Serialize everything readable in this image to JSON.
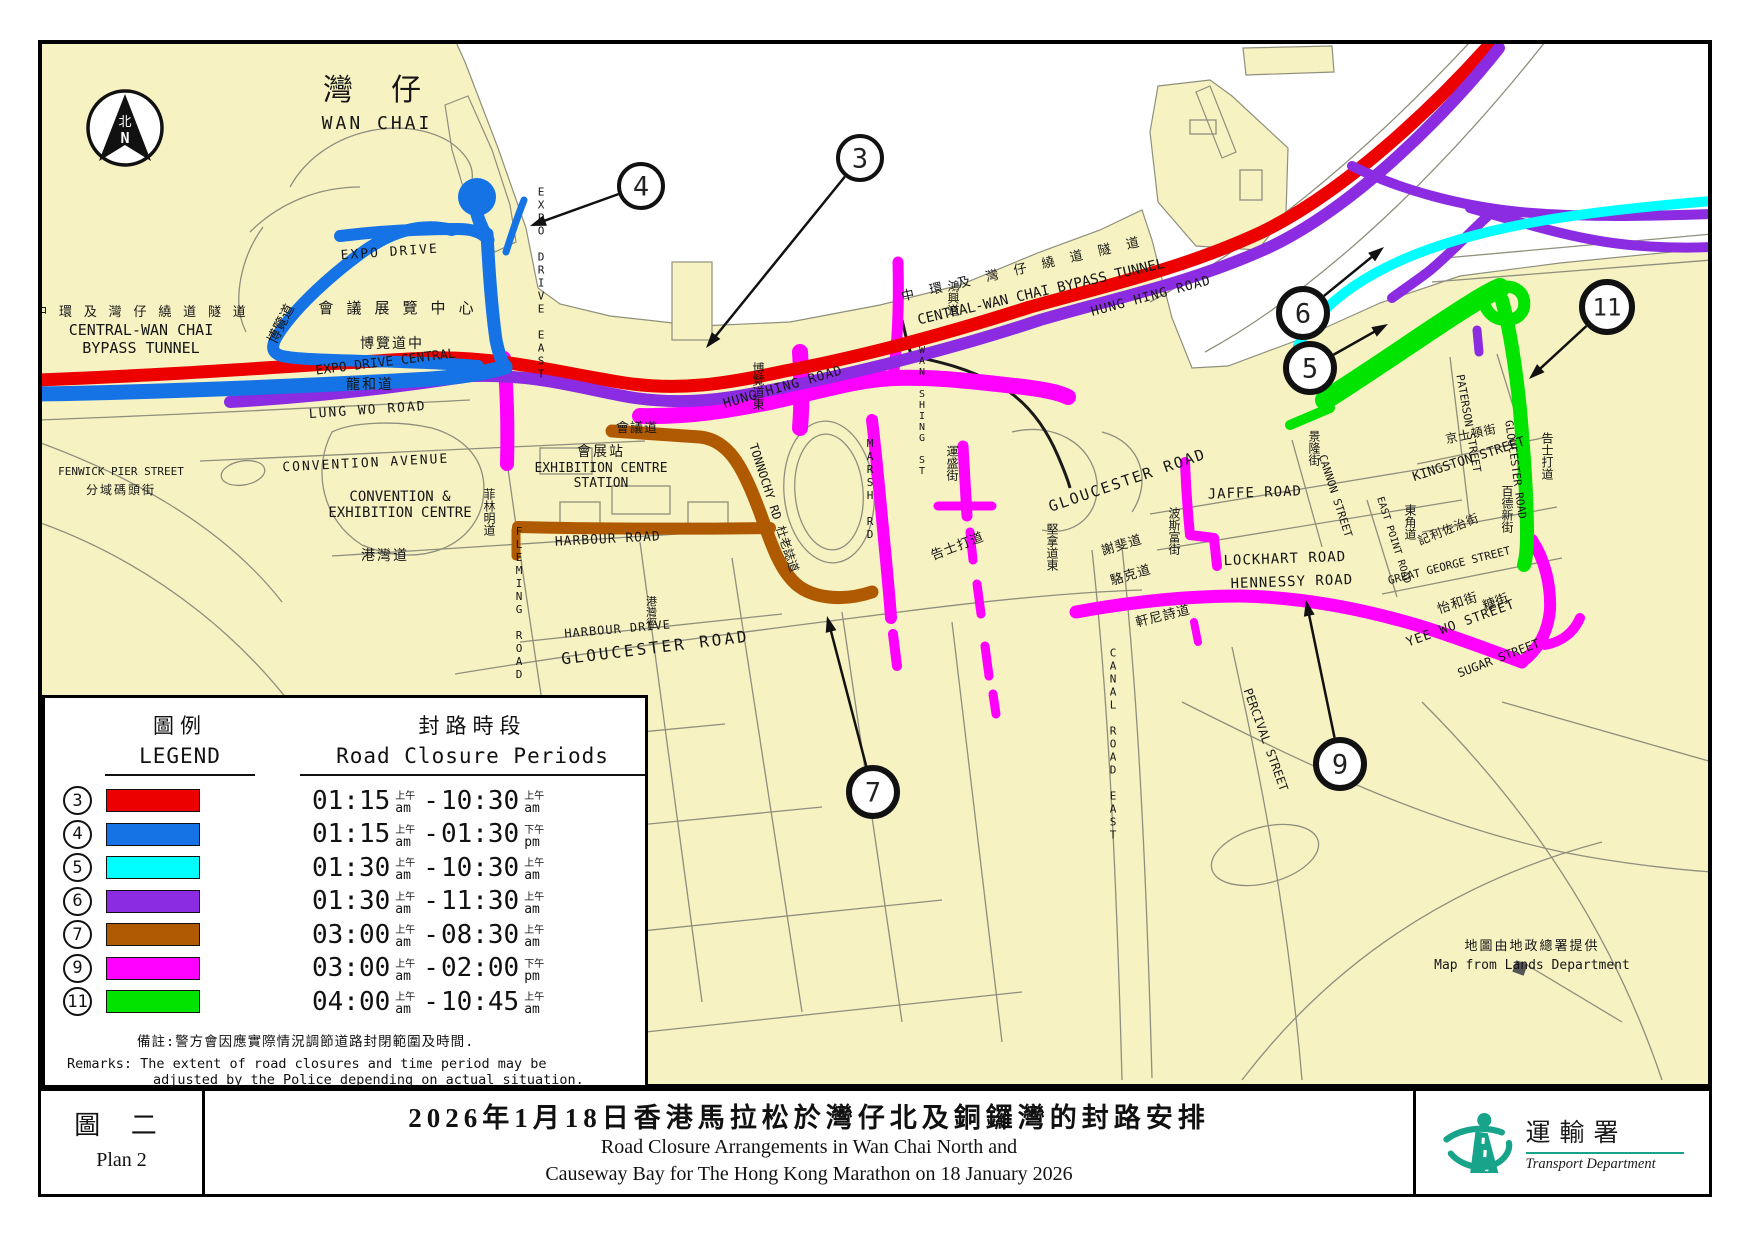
{
  "compass": {
    "zh": "北",
    "en": "N"
  },
  "legend": {
    "title_zh": "圖例",
    "title_en": "LEGEND",
    "periods_zh": "封路時段",
    "periods_en": "Road Closure Periods",
    "rows": [
      {
        "num": "3",
        "color": "#EC0000",
        "t1": "01:15",
        "z1": "上午",
        "e1": "am",
        "t2": "10:30",
        "z2": "上午",
        "e2": "am"
      },
      {
        "num": "4",
        "color": "#1573E6",
        "t1": "01:15",
        "z1": "上午",
        "e1": "am",
        "t2": "01:30",
        "z2": "下午",
        "e2": "pm"
      },
      {
        "num": "5",
        "color": "#00FFFF",
        "t1": "01:30",
        "z1": "上午",
        "e1": "am",
        "t2": "10:30",
        "z2": "上午",
        "e2": "am"
      },
      {
        "num": "6",
        "color": "#8B2BE2",
        "t1": "01:30",
        "z1": "上午",
        "e1": "am",
        "t2": "11:30",
        "z2": "上午",
        "e2": "am"
      },
      {
        "num": "7",
        "color": "#AF5A00",
        "t1": "03:00",
        "z1": "上午",
        "e1": "am",
        "t2": "08:30",
        "z2": "上午",
        "e2": "am"
      },
      {
        "num": "9",
        "color": "#FF00FF",
        "t1": "03:00",
        "z1": "上午",
        "e1": "am",
        "t2": "02:00",
        "z2": "下午",
        "e2": "pm"
      },
      {
        "num": "11",
        "color": "#00E400",
        "t1": "04:00",
        "z1": "上午",
        "e1": "am",
        "t2": "10:45",
        "z2": "上午",
        "e2": "am"
      }
    ],
    "remark_zh": "備註:警方會因應實際情況調節道路封閉範圍及時間.",
    "remark_en1": "Remarks: The extent of road closures and time period may be",
    "remark_en2": "adjusted by the Police depending on actual situation."
  },
  "callouts": [
    {
      "n": "3",
      "cx": 860,
      "cy": 158,
      "r": 22,
      "sw": 4,
      "tx": 706,
      "ty": 348
    },
    {
      "n": "4",
      "cx": 641,
      "cy": 186,
      "r": 22,
      "sw": 4,
      "tx": 530,
      "ty": 226
    },
    {
      "n": "5",
      "cx": 1310,
      "cy": 368,
      "r": 24,
      "sw": 6,
      "tx": 1388,
      "ty": 324
    },
    {
      "n": "6",
      "cx": 1303,
      "cy": 313,
      "r": 24,
      "sw": 6,
      "tx": 1384,
      "ty": 247
    },
    {
      "n": "7",
      "cx": 873,
      "cy": 792,
      "r": 24,
      "sw": 6,
      "tx": 827,
      "ty": 616
    },
    {
      "n": "9",
      "cx": 1340,
      "cy": 764,
      "r": 24,
      "sw": 6,
      "tx": 1306,
      "ty": 600
    },
    {
      "n": "11",
      "cx": 1607,
      "cy": 307,
      "r": 25,
      "sw": 6,
      "tx": 1529,
      "ty": 379
    }
  ],
  "labels": [
    {
      "t": "灣 仔",
      "x": 377,
      "y": 100,
      "s": 30,
      "ls": 10
    },
    {
      "t": "WAN CHAI",
      "x": 377,
      "y": 129,
      "s": 18,
      "ls": 3
    },
    {
      "t": "中 環 及 灣 仔 繞 道 隧 道",
      "x": 141,
      "y": 316,
      "s": 13,
      "ls": 2
    },
    {
      "t": "CENTRAL-WAN CHAI",
      "x": 141,
      "y": 335,
      "s": 15
    },
    {
      "t": "BYPASS TUNNEL",
      "x": 141,
      "y": 353,
      "s": 15
    },
    {
      "t": "會 議 展 覽 中 心",
      "x": 397,
      "y": 313,
      "s": 15,
      "ls": 2
    },
    {
      "t": "EXPO DRIVE",
      "x": 390,
      "y": 256,
      "s": 13,
      "r": -4,
      "ls": 2
    },
    {
      "t": "博覽道",
      "x": 285,
      "y": 326,
      "s": 14,
      "r": -63
    },
    {
      "t": "博覽道中",
      "x": 392,
      "y": 348,
      "s": 14,
      "ls": 2
    },
    {
      "t": "EXPO DRIVE CENTRAL",
      "x": 386,
      "y": 366,
      "s": 13,
      "r": -7
    },
    {
      "t": "龍和道",
      "x": 370,
      "y": 389,
      "s": 14,
      "ls": 2
    },
    {
      "t": "LUNG WO ROAD",
      "x": 368,
      "y": 414,
      "s": 13,
      "r": -4,
      "ls": 2
    },
    {
      "t": "EXPO DRIVE EAST",
      "x": 541,
      "y": 283,
      "s": 11,
      "v": 1
    },
    {
      "t": "博覽道東",
      "x": 758,
      "y": 386,
      "s": 12,
      "v": 1
    },
    {
      "t": "CONVENTION  AVENUE",
      "x": 366,
      "y": 467,
      "s": 13,
      "r": -3,
      "ls": 2
    },
    {
      "t": "CONVENTION &",
      "x": 400,
      "y": 501,
      "s": 14
    },
    {
      "t": "EXHIBITION CENTRE",
      "x": 400,
      "y": 517,
      "s": 14
    },
    {
      "t": "FENWICK PIER STREET",
      "x": 121,
      "y": 475,
      "s": 11
    },
    {
      "t": "分域碼頭街",
      "x": 121,
      "y": 494,
      "s": 12,
      "ls": 2
    },
    {
      "t": "菲林明道",
      "x": 489,
      "y": 512,
      "s": 12,
      "v": 1
    },
    {
      "t": "FLEMING ROAD",
      "x": 519,
      "y": 603,
      "s": 11,
      "v": 1
    },
    {
      "t": "HARBOUR  ROAD",
      "x": 608,
      "y": 543,
      "s": 13,
      "r": -3,
      "ls": 1
    },
    {
      "t": "港灣道",
      "x": 385,
      "y": 560,
      "s": 14,
      "ls": 2
    },
    {
      "t": "港灣徑",
      "x": 651,
      "y": 612,
      "s": 11,
      "v": 1
    },
    {
      "t": "HARBOUR DRIVE",
      "x": 618,
      "y": 633,
      "s": 12,
      "r": -5,
      "ls": 1
    },
    {
      "t": "GLOUCESTER   ROAD",
      "x": 656,
      "y": 653,
      "s": 16,
      "r": -7,
      "ls": 3
    },
    {
      "t": "會議道",
      "x": 637,
      "y": 432,
      "s": 13,
      "ls": 1
    },
    {
      "t": "會展站",
      "x": 601,
      "y": 456,
      "s": 14,
      "ls": 2
    },
    {
      "t": "EXHIBITION CENTRE",
      "x": 601,
      "y": 472,
      "s": 13
    },
    {
      "t": "STATION",
      "x": 601,
      "y": 487,
      "s": 13
    },
    {
      "t": "TONNOCHY RD 杜老誌道",
      "x": 770,
      "y": 509,
      "s": 12,
      "r": 72
    },
    {
      "t": "MARSH RD",
      "x": 870,
      "y": 489,
      "s": 11,
      "v": 1
    },
    {
      "t": "HUNG HING ROAD",
      "x": 784,
      "y": 391,
      "s": 13,
      "r": -16,
      "ls": 1
    },
    {
      "t": "HUNG HING ROAD",
      "x": 1152,
      "y": 300,
      "s": 13,
      "r": -15,
      "ls": 1
    },
    {
      "t": "鴻興道",
      "x": 953,
      "y": 298,
      "s": 12,
      "v": 1
    },
    {
      "t": "WAN SHING ST",
      "x": 922,
      "y": 411,
      "s": 10,
      "v": 1
    },
    {
      "t": "運盛街",
      "x": 952,
      "y": 463,
      "s": 12,
      "v": 1
    },
    {
      "t": "中 環 及 灣 仔 繞 道 隧 道",
      "x": 1023,
      "y": 273,
      "s": 13,
      "r": -13,
      "ls": 4
    },
    {
      "t": "CENTRAL-WAN CHAI BYPASS TUNNEL",
      "x": 1042,
      "y": 296,
      "s": 14,
      "r": -13
    },
    {
      "t": "GLOUCESTER  ROAD",
      "x": 1129,
      "y": 485,
      "s": 15,
      "r": -19,
      "ls": 2
    },
    {
      "t": "告士打道",
      "x": 959,
      "y": 550,
      "s": 13,
      "r": -21,
      "ls": 1
    },
    {
      "t": "堅拿道東",
      "x": 1052,
      "y": 547,
      "s": 12,
      "v": 1
    },
    {
      "t": "謝斐道",
      "x": 1123,
      "y": 549,
      "s": 13,
      "r": -17,
      "ls": 1
    },
    {
      "t": "駱克道",
      "x": 1132,
      "y": 579,
      "s": 13,
      "r": -17,
      "ls": 1
    },
    {
      "t": "軒尼詩道",
      "x": 1164,
      "y": 620,
      "s": 13,
      "r": -14,
      "ls": 1
    },
    {
      "t": "波斯富街",
      "x": 1174,
      "y": 531,
      "s": 12,
      "v": 1
    },
    {
      "t": "JAFFE ROAD",
      "x": 1255,
      "y": 497,
      "s": 14,
      "r": -2,
      "ls": 1
    },
    {
      "t": "LOCKHART  ROAD",
      "x": 1285,
      "y": 563,
      "s": 14,
      "r": -2,
      "ls": 1
    },
    {
      "t": "HENNESSY  ROAD",
      "x": 1292,
      "y": 586,
      "s": 14,
      "r": -2,
      "ls": 1
    },
    {
      "t": "CANAL  ROAD  EAST",
      "x": 1113,
      "y": 744,
      "s": 11,
      "v": 1
    },
    {
      "t": "PERCIVAL  STREET",
      "x": 1262,
      "y": 741,
      "s": 12,
      "r": 70
    },
    {
      "t": "景隆街",
      "x": 1314,
      "y": 448,
      "s": 12,
      "v": 1
    },
    {
      "t": "CANNON  STREET",
      "x": 1332,
      "y": 497,
      "s": 11,
      "r": 72
    },
    {
      "t": "EAST POINT ROAD",
      "x": 1391,
      "y": 541,
      "s": 10,
      "r": 72
    },
    {
      "t": "東角道",
      "x": 1410,
      "y": 522,
      "s": 12,
      "v": 1
    },
    {
      "t": "PATERSON  STREET",
      "x": 1465,
      "y": 424,
      "s": 11,
      "r": 80
    },
    {
      "t": "京士頓街",
      "x": 1472,
      "y": 438,
      "s": 12,
      "r": -12,
      "ls": 1
    },
    {
      "t": "KINGSTON STREET",
      "x": 1470,
      "y": 463,
      "s": 13,
      "r": -18
    },
    {
      "t": "百德新街",
      "x": 1507,
      "y": 509,
      "s": 12,
      "v": 1
    },
    {
      "t": "記利佐治街",
      "x": 1450,
      "y": 533,
      "s": 12,
      "r": -22,
      "ls": 1
    },
    {
      "t": "GREAT GEORGE STREET",
      "x": 1450,
      "y": 569,
      "s": 11,
      "r": -14
    },
    {
      "t": "怡和街",
      "x": 1459,
      "y": 607,
      "s": 13,
      "r": -18,
      "ls": 1
    },
    {
      "t": "YEE WO STREET",
      "x": 1462,
      "y": 627,
      "s": 13,
      "r": -20,
      "ls": 1
    },
    {
      "t": "糖街",
      "x": 1497,
      "y": 606,
      "s": 13,
      "r": -20
    },
    {
      "t": "SUGAR STREET",
      "x": 1500,
      "y": 662,
      "s": 12,
      "r": -21
    },
    {
      "t": "GLOUCESTER ROAD",
      "x": 1512,
      "y": 470,
      "s": 11,
      "r": 82
    },
    {
      "t": "告士打道",
      "x": 1547,
      "y": 456,
      "s": 12,
      "v": 1
    },
    {
      "t": "地圖由地政總署提供",
      "x": 1532,
      "y": 950,
      "s": 13,
      "ls": 2
    },
    {
      "t": "Map from Lands Department",
      "x": 1532,
      "y": 969,
      "s": 13
    }
  ],
  "footer": {
    "plan_zh": "圖 二",
    "plan_en": "Plan 2",
    "title_zh": "2026年1月18日香港馬拉松於灣仔北及銅鑼灣的封路安排",
    "title_en1": "Road Closure Arrangements in Wan Chai North and",
    "title_en2": "Causeway Bay for The Hong Kong Marathon on 18 January 2026",
    "dept_zh": "運輸署",
    "dept_en": "Transport Department",
    "dept_color": "#18A38B"
  },
  "map_colors": {
    "land": "#F6F2C2",
    "water": "#FFFFFF",
    "outline": "#8F8F7D"
  }
}
